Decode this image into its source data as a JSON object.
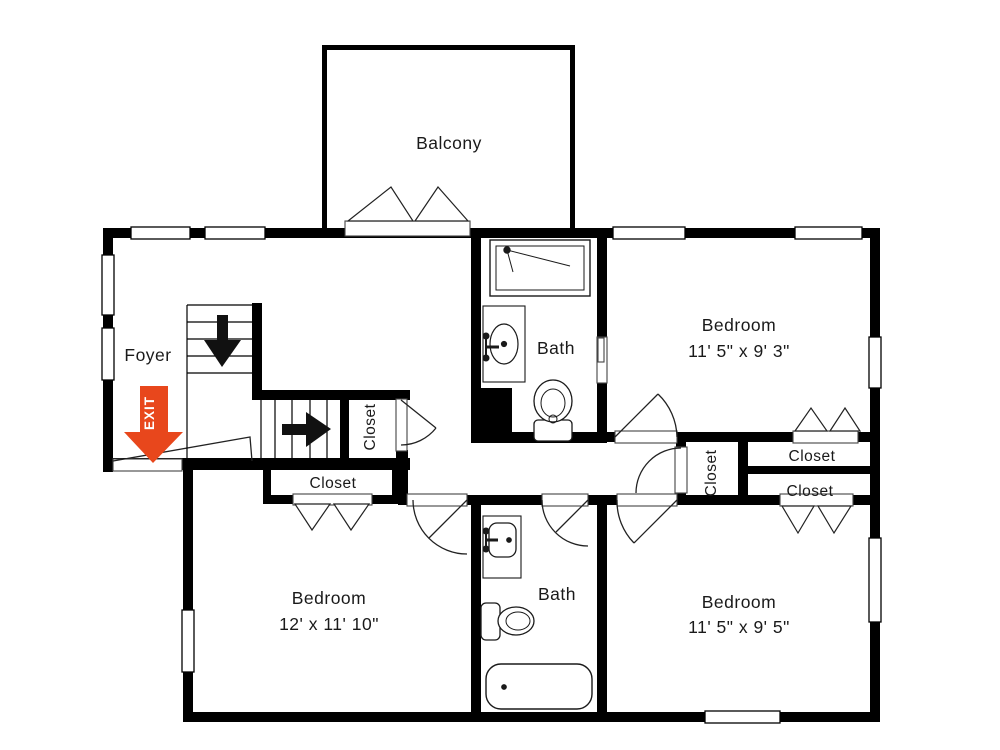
{
  "plan": {
    "balcony": "Balcony",
    "foyer": "Foyer",
    "exit": "EXIT",
    "bath_upper": "Bath",
    "bath_lower": "Bath",
    "bedroom_upper_right": {
      "name": "Bedroom",
      "size": "11' 5\" x 9' 3\""
    },
    "bedroom_lower_left": {
      "name": "Bedroom",
      "size": "12' x 11' 10\""
    },
    "bedroom_lower_right": {
      "name": "Bedroom",
      "size": "11' 5\" x 9' 5\""
    },
    "closet_stair": "Closet",
    "closet_under_stair": "Closet",
    "closet_hall": "Closet",
    "closet_right_upper": "Closet",
    "closet_right_lower": "Closet"
  },
  "colors": {
    "wall": "#000000",
    "exit_arrow": "#E8471C",
    "line": "#222222"
  }
}
